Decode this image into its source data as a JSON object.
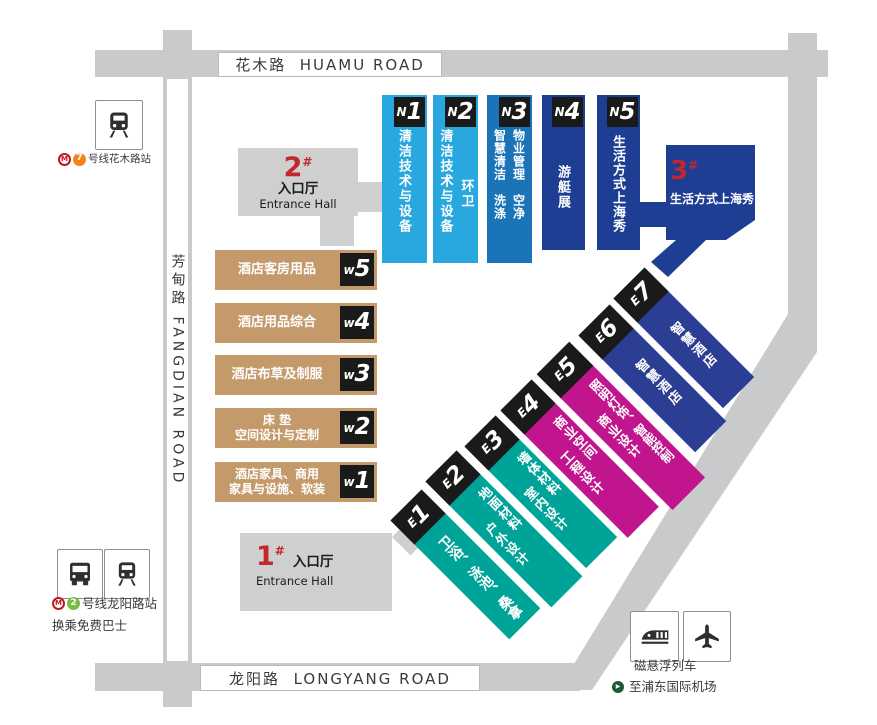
{
  "roads": {
    "huamu": "花木路  HUAMU ROAD",
    "fangdian": "芳甸路 FANGDIAN ROAD",
    "longyang": "龙阳路  LONGYANG ROAD"
  },
  "entrances": {
    "e2": {
      "num": "2",
      "sup": "#",
      "cn": "入口厅",
      "en": "Entrance Hall"
    },
    "e1": {
      "num": "1",
      "sup": "#",
      "cn": "入口厅",
      "en": "Entrance Hall"
    },
    "e3": {
      "num": "3",
      "sup": "#",
      "label": "生活方式上海秀"
    }
  },
  "halls": {
    "north": [
      {
        "letter": "N",
        "digit": "1",
        "columns": [
          "清洁技术与设备"
        ]
      },
      {
        "letter": "N",
        "digit": "2",
        "columns": [
          "清洁技术与设备",
          "环卫"
        ]
      },
      {
        "letter": "N",
        "digit": "3",
        "columns": [
          "智慧清洁　洗涤",
          "物业管理　空净"
        ]
      },
      {
        "letter": "N",
        "digit": "4",
        "columns": [
          "游艇展"
        ]
      },
      {
        "letter": "N",
        "digit": "5",
        "columns": [
          "生活方式上海秀"
        ]
      }
    ],
    "west": [
      {
        "letter": "w",
        "digit": "5",
        "lines": [
          "酒店客房用品"
        ]
      },
      {
        "letter": "w",
        "digit": "4",
        "lines": [
          "酒店用品综合"
        ]
      },
      {
        "letter": "w",
        "digit": "3",
        "lines": [
          "酒店布草及制服"
        ]
      },
      {
        "letter": "w",
        "digit": "2",
        "lines": [
          "床 垫",
          "空间设计与定制"
        ]
      },
      {
        "letter": "w",
        "digit": "1",
        "lines": [
          "酒店家具、商用",
          "家具与设施、软装"
        ]
      }
    ],
    "east": [
      {
        "letter": "E",
        "digit": "1",
        "columns": [
          "卫浴、泳池、桑拿"
        ]
      },
      {
        "letter": "E",
        "digit": "2",
        "columns": [
          "地面材料",
          "户外设计"
        ]
      },
      {
        "letter": "E",
        "digit": "3",
        "columns": [
          "墙体材料",
          "室内设计"
        ]
      },
      {
        "letter": "E",
        "digit": "4",
        "columns": [
          "商业空间",
          "工程设计"
        ]
      },
      {
        "letter": "E",
        "digit": "5",
        "columns": [
          "照明灯饰、智能控制",
          "商业设计"
        ]
      },
      {
        "letter": "E",
        "digit": "6",
        "columns": [
          "智慧酒店"
        ]
      },
      {
        "letter": "E",
        "digit": "7",
        "columns": [
          "智慧酒店"
        ]
      }
    ]
  },
  "stations": {
    "huamu": {
      "logo": "M",
      "line_num": "7",
      "label": "号线花木路站"
    },
    "longyang": {
      "logo": "M",
      "line_num": "2",
      "label": "号线龙阳路站",
      "sub": "换乘免费巴士"
    },
    "maglev": {
      "line1": "磁悬浮列车",
      "arrow": "▶",
      "line2": "至浦东国际机场"
    }
  },
  "colors": {
    "n_light_blue": "#29A8E0",
    "n_mid_blue": "#1B74B8",
    "navy": "#1D3E93",
    "e_navy": "#2B3E94",
    "teal": "#00A398",
    "magenta": "#C0158C",
    "tan": "#C49A6B",
    "entrance_red": "#C1272D",
    "road_gray": "#C9CACB",
    "entrance_gray": "#CFCFD0",
    "hall_label_black": "#1A1A1A",
    "line7_orange": "#F5821F",
    "line2_green": "#78BE43",
    "metro_red": "#C0161D"
  }
}
